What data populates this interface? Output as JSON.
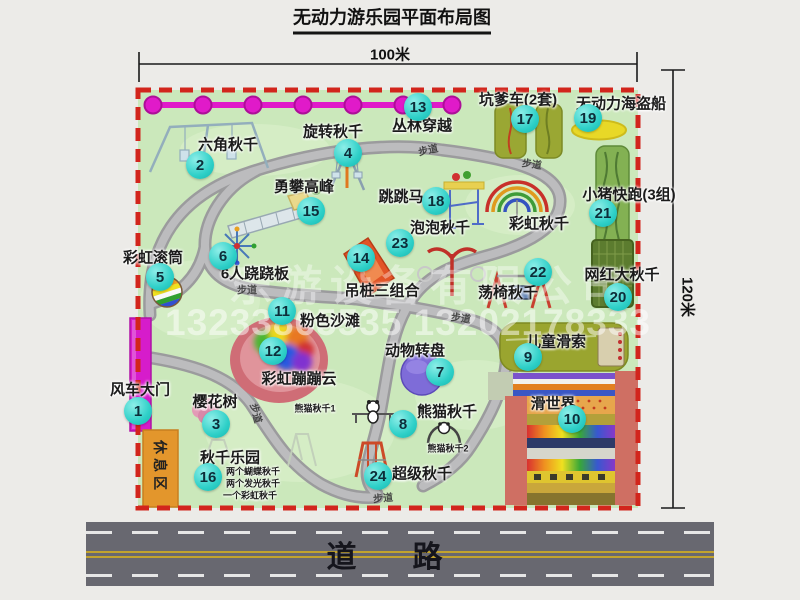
{
  "title": "无动力游乐园平面布局图",
  "dimensions": {
    "top": "100米",
    "right": "120米"
  },
  "road": {
    "label": "道路"
  },
  "trail_label": "步道",
  "rest_area_label": "休息区",
  "watermark": {
    "company": "乐游设备有限公司",
    "phone": "13233865535 13202178333"
  },
  "extra_labels": {
    "rainbow_swing": "彩虹秋千",
    "panda_swing_1": "熊猫秋千1",
    "panda_swing_2": "熊猫秋千2"
  },
  "swing_park_notes": [
    "两个蝴蝶秋千",
    "两个发光秋千",
    "一个彩虹秋千"
  ],
  "facilities": [
    {
      "num": "1",
      "name": "风车大门"
    },
    {
      "num": "2",
      "name": "六角秋千"
    },
    {
      "num": "3",
      "name": "樱花树"
    },
    {
      "num": "4",
      "name": "旋转秋千"
    },
    {
      "num": "5",
      "name": "彩虹滚筒"
    },
    {
      "num": "6",
      "name": "6人跷跷板"
    },
    {
      "num": "7",
      "name": "动物转盘"
    },
    {
      "num": "8",
      "name": "熊猫秋千"
    },
    {
      "num": "9",
      "name": "儿童滑索"
    },
    {
      "num": "10",
      "name": "滑世界"
    },
    {
      "num": "11",
      "name": "粉色沙滩"
    },
    {
      "num": "12",
      "name": "彩虹蹦蹦云"
    },
    {
      "num": "13",
      "name": "丛林穿越"
    },
    {
      "num": "14",
      "name": "吊桩三组合"
    },
    {
      "num": "15",
      "name": "勇攀高峰"
    },
    {
      "num": "16",
      "name": "秋千乐园"
    },
    {
      "num": "17",
      "name": "坑爹车(2套)"
    },
    {
      "num": "18",
      "name": "跳跳马"
    },
    {
      "num": "19",
      "name": "无动力海盗船"
    },
    {
      "num": "20",
      "name": "网红大秋千"
    },
    {
      "num": "21",
      "name": "小猪快跑(3组)"
    },
    {
      "num": "22",
      "name": "荡椅秋千"
    },
    {
      "num": "23",
      "name": "泡泡秋千"
    },
    {
      "num": "24",
      "name": "超级秋千"
    }
  ],
  "colors": {
    "map_green": "#cbe8bb",
    "border_red": "#d2251c",
    "fence_magenta": "#dd18ca",
    "marker_teal": "#2fd0c8",
    "road_gray": "#686870",
    "rest_orange": "#e3962c"
  }
}
